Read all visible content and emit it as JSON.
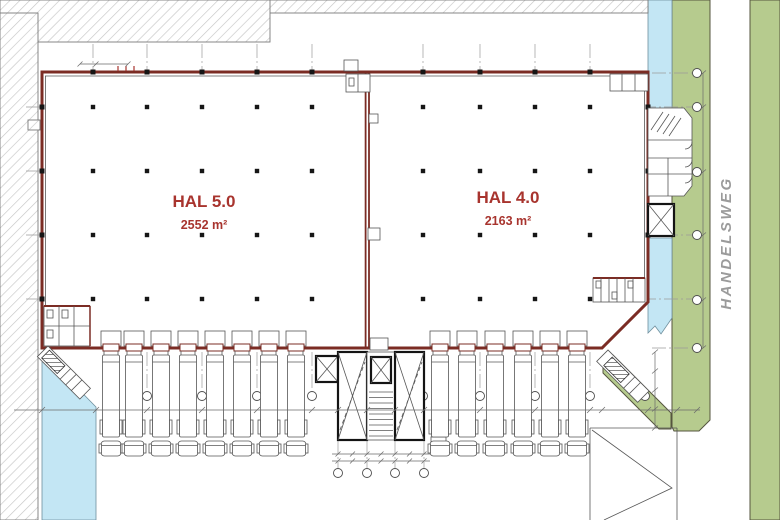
{
  "plan": {
    "halls": [
      {
        "name": "HAL 5.0",
        "area": "2552 m²"
      },
      {
        "name": "HAL 4.0",
        "area": "2163 m²"
      }
    ],
    "street": {
      "name": "HANDELSWEG"
    },
    "docks": {
      "left_truck_count": 8,
      "right_truck_count": 6
    }
  },
  "colors": {
    "accent": "#a8342e",
    "wall": "#7b2c24",
    "green": "#b6cb8e",
    "water": "#c3e6f4",
    "grid": "#9a9a9a",
    "line": "#565656",
    "street_text": "#9b9b9b",
    "hatch": "#c6c6c6"
  }
}
